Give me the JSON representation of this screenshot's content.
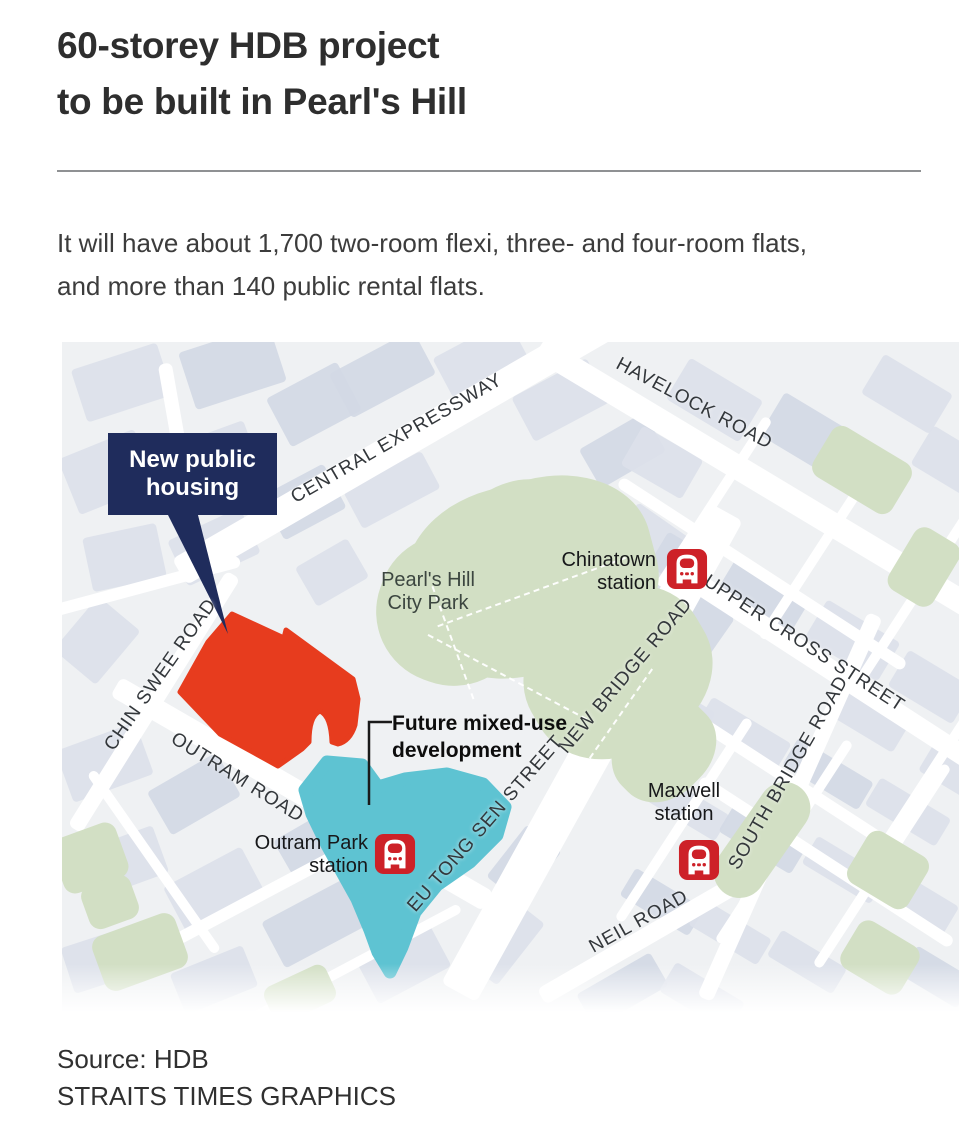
{
  "header": {
    "title_line1": "60-storey HDB project",
    "title_line2": "to be built in Pearl's Hill",
    "description_line1": "It will have about 1,700 two-room flexi, three- and four-room flats,",
    "description_line2": "and more than 140 public rental flats."
  },
  "map": {
    "callout": {
      "line1": "New public",
      "line2": "housing"
    },
    "roads": {
      "central_expressway": "CENTRAL EXPRESSWAY",
      "havelock": "HAVELOCK ROAD",
      "chin_swee": "CHIN SWEE ROAD",
      "outram": "OUTRAM ROAD",
      "upper_cross": "UPPER CROSS STREET",
      "new_bridge": "NEW BRIDGE ROAD",
      "south_bridge": "SOUTH BRIDGE ROAD",
      "eu_tong_sen": "EU TONG SEN STREET",
      "neil": "NEIL ROAD"
    },
    "places": {
      "park_line1": "Pearl's Hill",
      "park_line2": "City Park",
      "future_dev_line1": "Future mixed-use",
      "future_dev_line2": "development"
    },
    "stations": [
      {
        "id": "chinatown",
        "line1": "Chinatown",
        "line2": "station"
      },
      {
        "id": "outram-park",
        "line1": "Outram Park",
        "line2": "station"
      },
      {
        "id": "maxwell",
        "line1": "Maxwell",
        "line2": "station"
      }
    ],
    "colors": {
      "new_housing": "#e73c1e",
      "future_dev": "#5ec3d2",
      "callout_bg": "#1f2c5c",
      "station_icon": "#cd2128",
      "park": "#d2dfc4",
      "building": "#dce1ea",
      "map_bg": "#eff1f3"
    }
  },
  "footer": {
    "source": "Source: HDB",
    "credit": "STRAITS TIMES GRAPHICS"
  }
}
